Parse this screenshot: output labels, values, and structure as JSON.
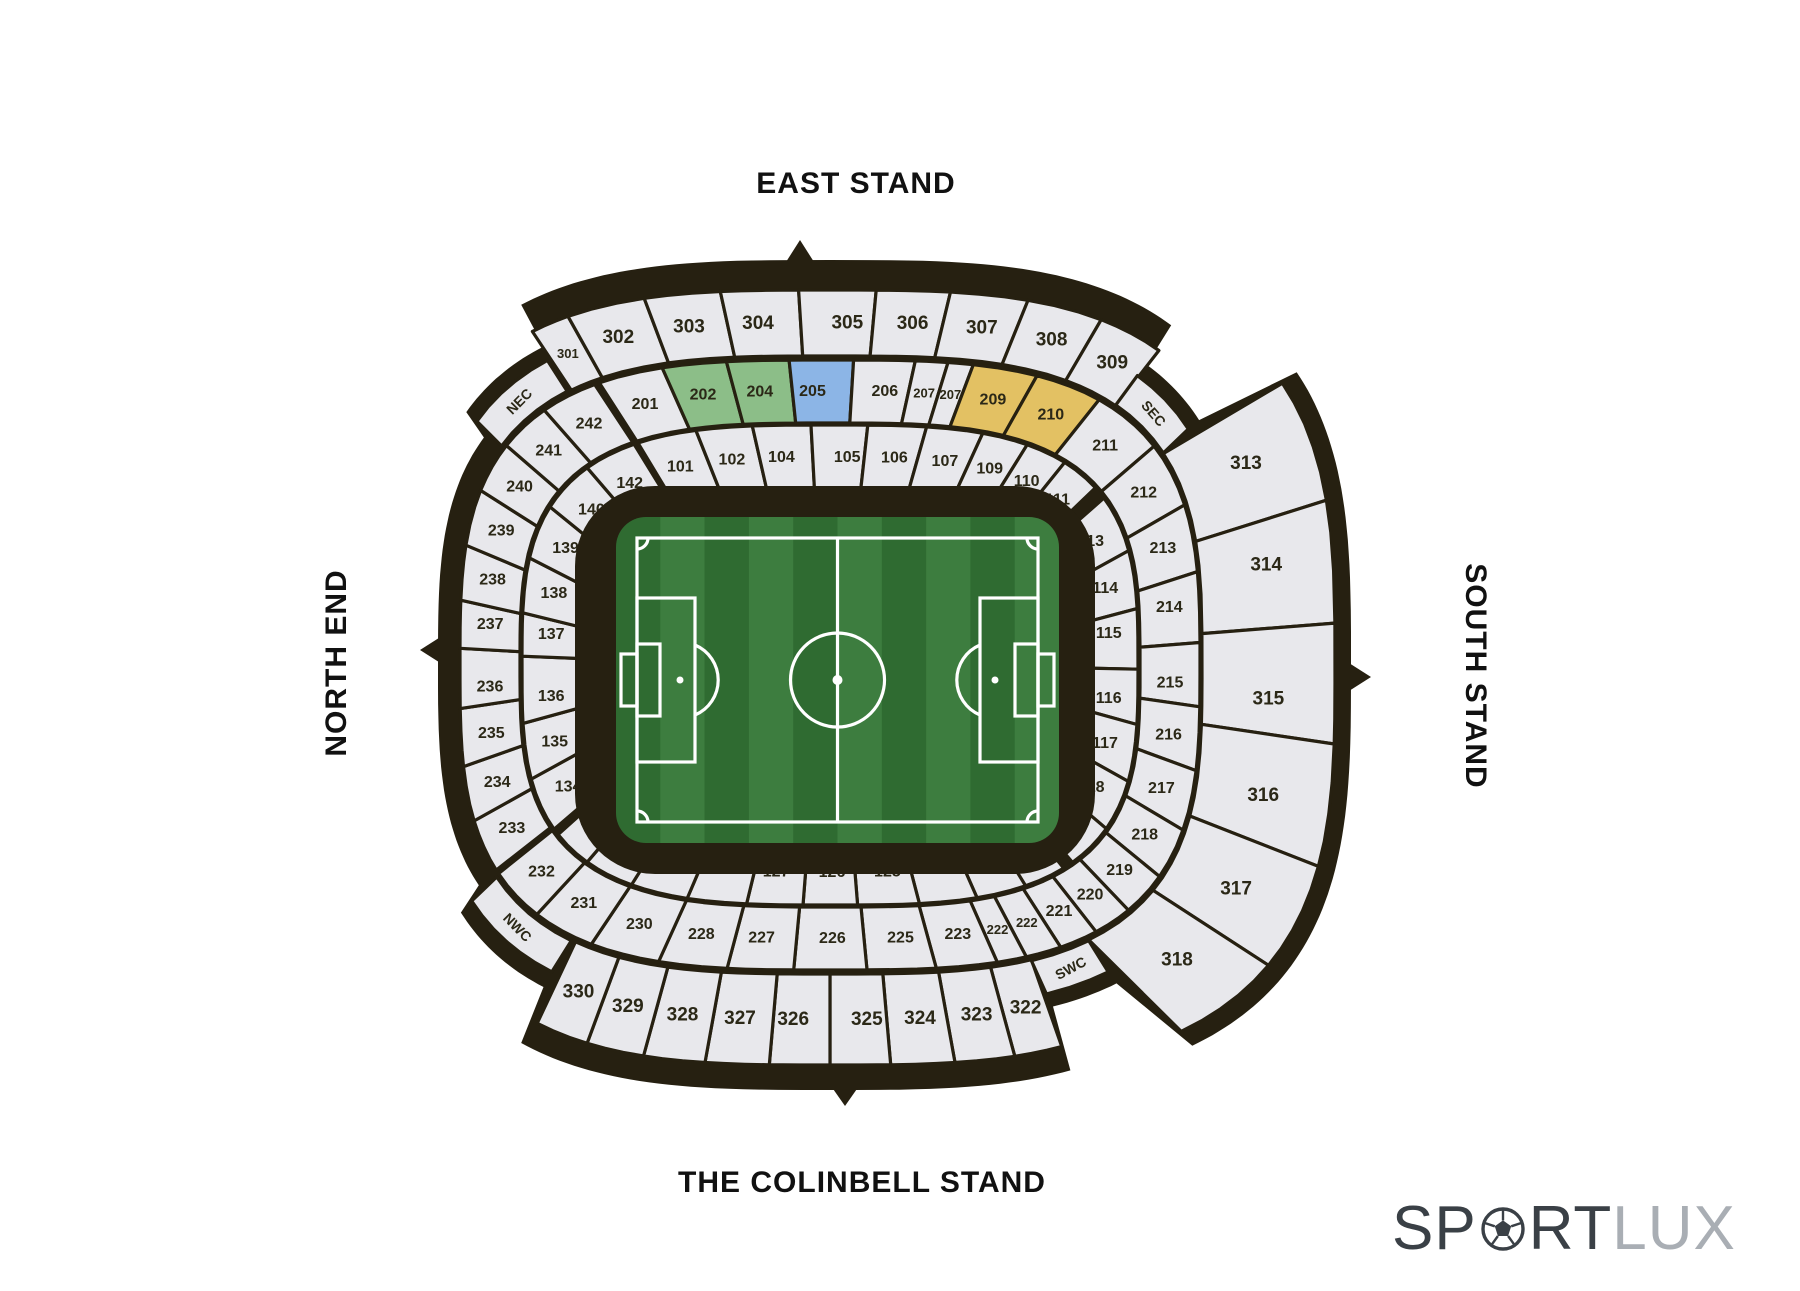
{
  "labels": {
    "east": "EAST STAND",
    "north": "NORTH END",
    "south": "SOUTH STAND",
    "west": "THE COLINBELL STAND"
  },
  "logo": {
    "full": "SPORTLUX",
    "part1": "SP",
    "part2": "RT",
    "part3": "LUX",
    "ball_icon": "football-icon"
  },
  "colors": {
    "outline": "#262011",
    "section_fill": "#e8e8ec",
    "section_label": "#2b2817",
    "highlight_green": "#8cbe88",
    "highlight_blue": "#8cb5e6",
    "highlight_gold": "#e3c163",
    "pitch_dark_stripe": "#2f6b31",
    "pitch_light_stripe": "#3d7d3f",
    "pitch_line": "#ffffff",
    "logo_dark": "#3a4046",
    "logo_light": "#a9aeb4"
  },
  "corners": [
    {
      "label": "NEC",
      "a0": -55,
      "a1": -35
    },
    {
      "label": "SEC",
      "a0": 41,
      "a1": 57
    },
    {
      "label": "SWC",
      "a0": 146,
      "a1": 158
    },
    {
      "label": "NWC",
      "a0": 214,
      "a1": 237
    }
  ],
  "rings": {
    "inner": {
      "runs": [
        {
          "a0": -28,
          "a1": 52,
          "sections": [
            {
              "n": "101"
            },
            {
              "n": "102"
            },
            {
              "n": "104"
            },
            {
              "n": "105"
            },
            {
              "n": "106"
            },
            {
              "n": "107"
            },
            {
              "n": "109",
              "w": 0.8
            },
            {
              "n": "110",
              "w": 0.7
            },
            {
              "n": "111",
              "w": 0.7
            }
          ]
        },
        {
          "a0": 56,
          "a1": 137,
          "sections": [
            {
              "n": "113"
            },
            {
              "n": "114"
            },
            {
              "n": "115"
            },
            {
              "n": "116"
            },
            {
              "n": "117"
            },
            {
              "n": "118",
              "w": 0.9
            },
            {
              "n": "119",
              "w": 0.85
            }
          ]
        },
        {
          "a0": 140,
          "a1": 235,
          "sections": [
            {
              "n": "121",
              "w": 0.7
            },
            {
              "n": "122",
              "w": 0.85
            },
            {
              "n": "123"
            },
            {
              "n": "125"
            },
            {
              "n": "126"
            },
            {
              "n": "127"
            },
            {
              "n": "128"
            },
            {
              "n": "130"
            },
            {
              "n": "131",
              "w": 0.85
            },
            {
              "n": "132",
              "w": 0.7
            }
          ]
        },
        {
          "a0": 237,
          "a1": 331,
          "sections": [
            {
              "n": "134"
            },
            {
              "n": "135"
            },
            {
              "n": "136"
            },
            {
              "n": "137"
            },
            {
              "n": "138"
            },
            {
              "n": "139"
            },
            {
              "n": "140"
            },
            {
              "n": "142"
            }
          ]
        }
      ]
    },
    "middle": {
      "runs": [
        {
          "a0": -28,
          "a1": 54,
          "sections": [
            {
              "n": "201"
            },
            {
              "n": "202",
              "c": "green"
            },
            {
              "n": "204",
              "c": "green"
            },
            {
              "n": "205",
              "c": "blue",
              "w": 0.95
            },
            {
              "n": "206"
            },
            {
              "n": "207",
              "w": 0.55
            },
            {
              "n": "207",
              "w": 0.4
            },
            {
              "n": "209",
              "c": "gold"
            },
            {
              "n": "210",
              "c": "gold",
              "w": 1.05
            },
            {
              "n": "211",
              "w": 1.15
            }
          ]
        },
        {
          "a0": 54,
          "a1": 152,
          "sections": [
            {
              "n": "212"
            },
            {
              "n": "213"
            },
            {
              "n": "214"
            },
            {
              "n": "215"
            },
            {
              "n": "216"
            },
            {
              "n": "217",
              "w": 0.9
            },
            {
              "n": "218",
              "w": 0.8
            },
            {
              "n": "219",
              "w": 0.7
            },
            {
              "n": "220",
              "w": 0.6
            },
            {
              "n": "221",
              "w": 0.6
            }
          ]
        },
        {
          "a0": 152,
          "a1": 237,
          "sections": [
            {
              "n": "222",
              "w": 0.5
            },
            {
              "n": "222",
              "w": 0.42
            },
            {
              "n": "223",
              "w": 0.9
            },
            {
              "n": "225"
            },
            {
              "n": "226"
            },
            {
              "n": "227"
            },
            {
              "n": "228"
            },
            {
              "n": "230"
            },
            {
              "n": "231",
              "w": 0.9
            },
            {
              "n": "232",
              "w": 0.8
            }
          ]
        },
        {
          "a0": 238,
          "a1": 331,
          "sections": [
            {
              "n": "233",
              "w": 0.95
            },
            {
              "n": "234"
            },
            {
              "n": "235"
            },
            {
              "n": "236"
            },
            {
              "n": "237"
            },
            {
              "n": "238"
            },
            {
              "n": "239"
            },
            {
              "n": "240",
              "w": 0.95
            },
            {
              "n": "241",
              "w": 0.95
            },
            {
              "n": "242",
              "w": 1.05
            }
          ]
        }
      ]
    },
    "outer": {
      "runs": [
        {
          "a0": -34,
          "a1": 41,
          "sections": [
            {
              "n": "301",
              "w": 0.5
            },
            {
              "n": "302"
            },
            {
              "n": "303"
            },
            {
              "n": "304"
            },
            {
              "n": "305"
            },
            {
              "n": "306"
            },
            {
              "n": "307"
            },
            {
              "n": "308"
            },
            {
              "n": "309",
              "w": 0.85
            }
          ]
        },
        {
          "a0": 57,
          "a1": 146,
          "sections": [
            {
              "n": "313"
            },
            {
              "n": "314"
            },
            {
              "n": "315"
            },
            {
              "n": "316"
            },
            {
              "n": "317",
              "w": 0.9
            },
            {
              "n": "318",
              "w": 0.9
            }
          ]
        },
        {
          "a0": 158,
          "a1": 213,
          "sections": [
            {
              "n": "322",
              "w": 0.8
            },
            {
              "n": "323"
            },
            {
              "n": "324",
              "w": 1.05
            },
            {
              "n": "325",
              "w": 1.05
            },
            {
              "n": "326",
              "w": 1.05
            },
            {
              "n": "327",
              "w": 1.05
            },
            {
              "n": "328",
              "w": 1.05
            },
            {
              "n": "329"
            },
            {
              "n": "330",
              "w": 0.9
            }
          ]
        }
      ]
    }
  }
}
